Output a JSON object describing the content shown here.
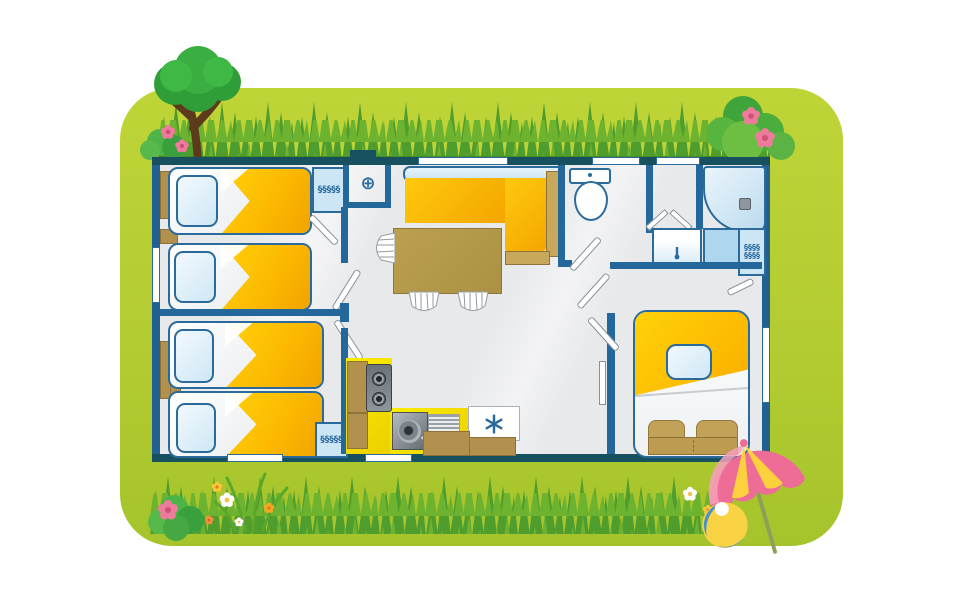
{
  "scene": {
    "type": "illustrated-floor-plan",
    "subject": "mobile-home / cottage top-view floor plan on a grassy lawn",
    "rooms": [
      {
        "name": "bedroom-twin-top-left",
        "furniture": [
          "single-bed",
          "single-bed",
          "pillows",
          "headboard-shelves",
          "wardrobe-with-hangers"
        ]
      },
      {
        "name": "bedroom-twin-bottom-left",
        "furniture": [
          "single-bed",
          "single-bed",
          "pillows",
          "headboard-shelves",
          "wardrobe-with-hangers"
        ]
      },
      {
        "name": "entry-utility-closet",
        "furniture": [
          "utility-symbol"
        ]
      },
      {
        "name": "living-dining",
        "furniture": [
          "corner-sofa",
          "dining-table",
          "chair",
          "chair",
          "chair"
        ]
      },
      {
        "name": "kitchen",
        "furniture": [
          "worktop",
          "hob-two-burners",
          "sink",
          "drainer",
          "fridge",
          "cabinets"
        ]
      },
      {
        "name": "wc",
        "furniture": [
          "toilet"
        ]
      },
      {
        "name": "bathroom",
        "furniture": [
          "shower",
          "washbasin",
          "wardrobe-with-hangers"
        ]
      },
      {
        "name": "master-bedroom",
        "furniture": [
          "double-bed",
          "pillow",
          "bench",
          "stools"
        ]
      }
    ],
    "outdoor_elements": [
      "tree",
      "flowering-bush-top-right",
      "grass-top",
      "grass-bottom",
      "flowers",
      "bush-bottom-left",
      "beach-umbrella",
      "beach-ball"
    ]
  },
  "glyphs": {
    "hanger_row_5": "§§§§§",
    "hanger_row_4": "§§§§",
    "utility_symbol": "⊕"
  },
  "counts": {
    "single_beds": 4,
    "double_beds": 1,
    "windows": 7,
    "wardrobes": 3
  },
  "palette": {
    "card_green": "#b3cc31",
    "grass_dark": "#4f9d2c",
    "grass_light": "#6db32f",
    "wall_blue": "#20618f",
    "wall_teal": "#17505f",
    "floor_gray": "#e8e9eb",
    "bed_yellow": "#fcb900",
    "counter_yellow": "#f8e600",
    "wood_tan": "#b2914e",
    "table_brown": "#b49a4d",
    "pillow_blue": "#d8ecf8",
    "wardrobe_blue": "#cde6f5",
    "shower_blue": "#cfe6f4",
    "snowflake_blue": "#2a6b9f",
    "tree_green": "#3aae41",
    "trunk_brown": "#5d3a1c",
    "flower_pink": "#ee7b9b",
    "umbrella_pink": "#ee6d96",
    "umbrella_yellow": "#fcd13d",
    "ball_blue": "#4a93c8",
    "ball_yellow": "#f9d243"
  }
}
